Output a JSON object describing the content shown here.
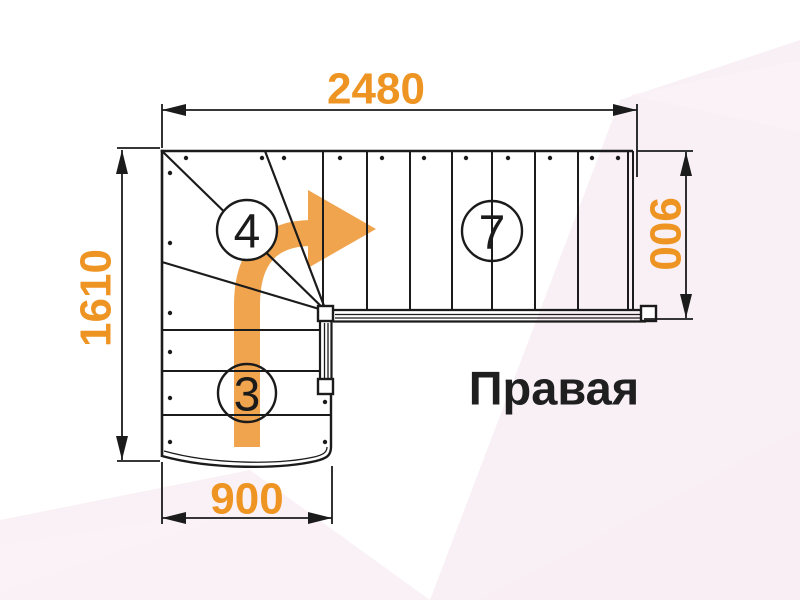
{
  "title": "Правая",
  "dimensions": {
    "top": "2480",
    "left": "1610",
    "right": "900",
    "bottom": "900"
  },
  "step_labels": {
    "winder_steps": "4",
    "upper_flight_steps": "7",
    "lower_flight_steps": "3"
  },
  "direction": "turn-right",
  "colors": {
    "dimension_text": "#EE9422",
    "arrow": "#F1A44E",
    "line": "#1B1B1B",
    "background_pink": "#F3E4ED",
    "background_light": "#FBF2F8"
  }
}
